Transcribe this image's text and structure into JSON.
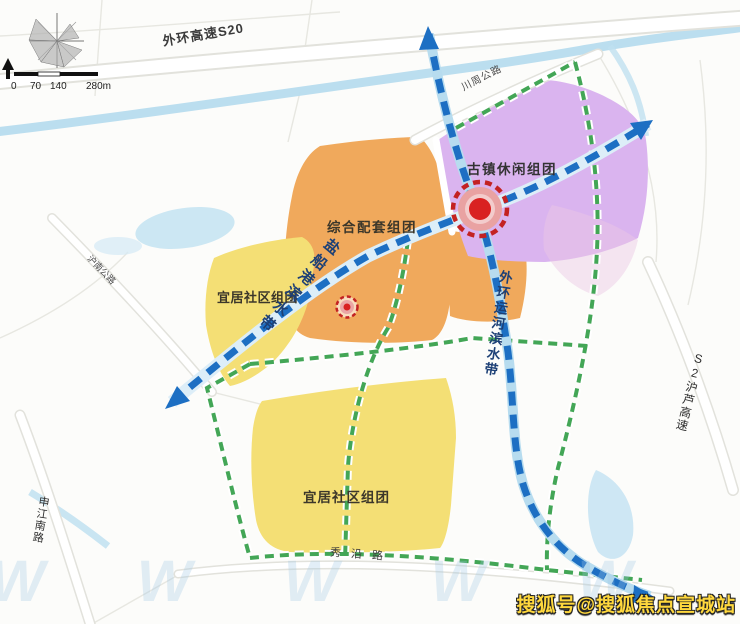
{
  "map": {
    "scale_bar": {
      "ticks": [
        "0",
        "70",
        "140",
        "280m"
      ]
    },
    "roads": {
      "s20": "外环高速S20",
      "chuanzhou": "川周公路",
      "hunan": "沪南公路",
      "shenjiang": "申江南路",
      "s2": "S2沪芦高速",
      "xiuyan": "秀沿路"
    },
    "zones": {
      "composite": "综合配套组团",
      "ancient_town": "古镇休闲组团",
      "residential_upper": "宜居社区组团",
      "residential_lower": "宜居社区组团"
    },
    "waterfronts": {
      "yanchuangang": "盐船港滨水带",
      "waihuan_canal": "外环运河滨水带"
    },
    "watermark": "搜狐号@搜狐焦点宣城站",
    "watermark_glyph": "W W W W W",
    "colors": {
      "zone_orange": "#f0a95c",
      "zone_purple": "#dab4ef",
      "zone_yellow": "#f4df75",
      "axis_blue": "#1d6fc3",
      "greenway_green": "#43a656",
      "node_red": "#d92121",
      "water_blue": "#bcdeef",
      "watermark_yellow": "#ffd83d"
    }
  }
}
